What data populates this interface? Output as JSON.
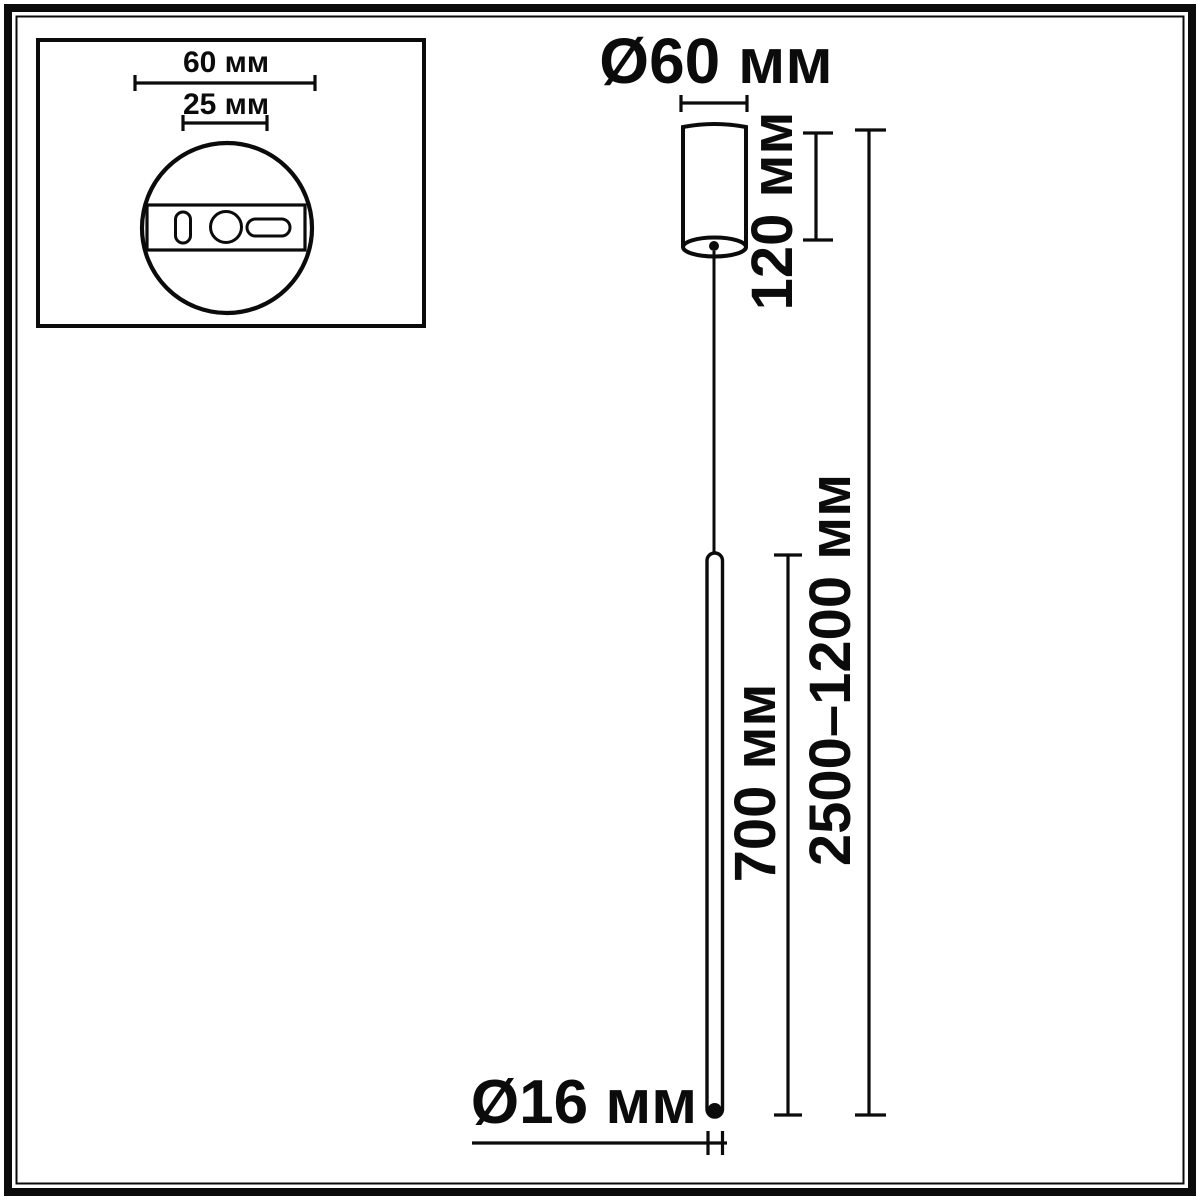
{
  "diagram": {
    "kind": "pendant-lamp-dimension-drawing",
    "colors": {
      "line": "#0b0b0b",
      "background": "#ffffff"
    },
    "inset_plate": {
      "outer_width_label": "60 мм",
      "inner_width_label": "25 мм"
    },
    "main_view": {
      "canopy_diameter_label": "Ø60 мм",
      "canopy_height_label": "120 мм",
      "lamp_tube_length_label": "700 мм",
      "overall_height_range_label": "2500–1200 мм",
      "tube_diameter_label": "Ø16 мм"
    }
  }
}
